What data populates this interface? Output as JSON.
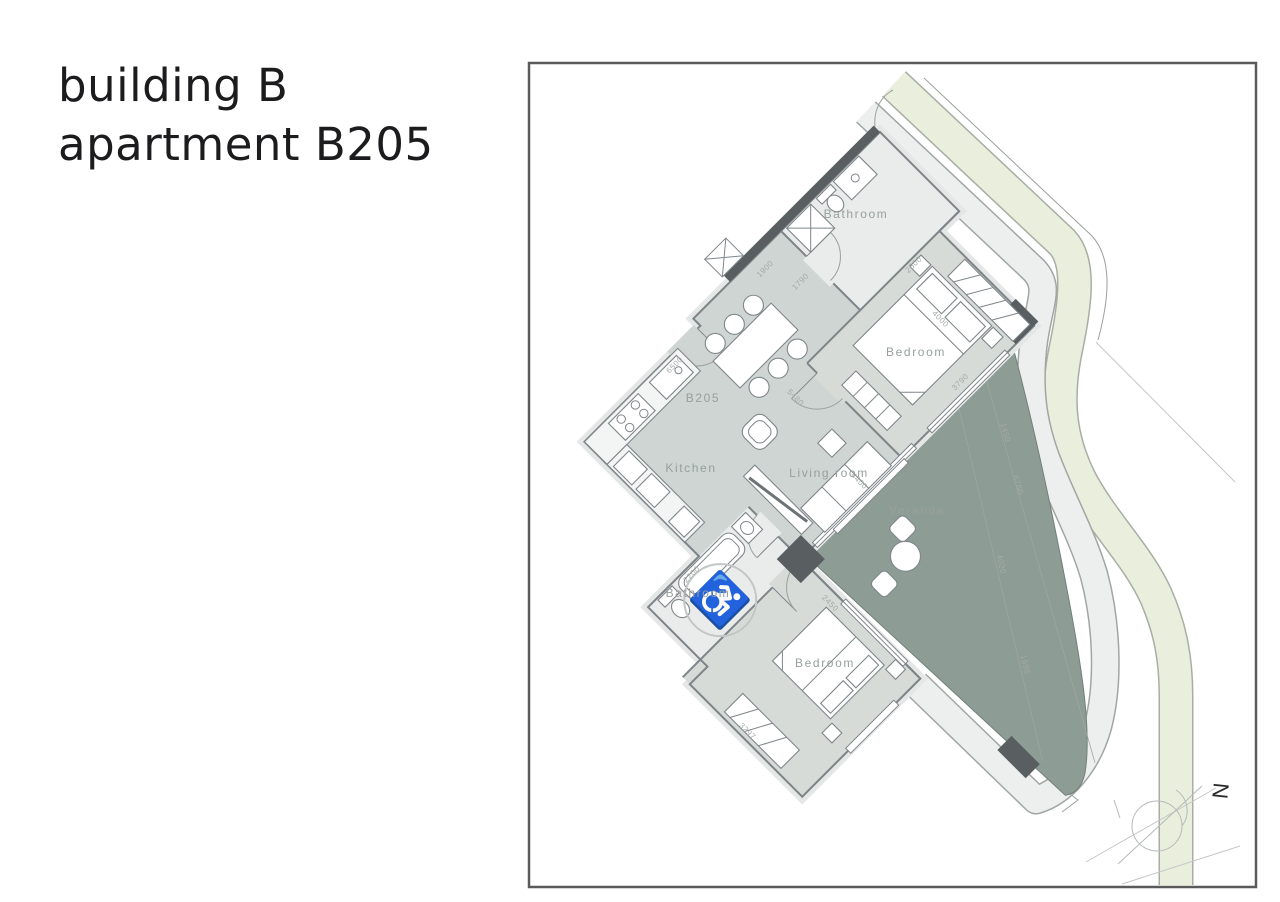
{
  "header": {
    "line1": "building B",
    "line2": "apartment B205"
  },
  "plan": {
    "room_labels": [
      {
        "text": "Bathroom"
      },
      {
        "text": "Bedroom"
      },
      {
        "text": "B205"
      },
      {
        "text": "Kitchen"
      },
      {
        "text": "Living  room"
      },
      {
        "text": "Veranda"
      },
      {
        "text": "Bathroom"
      },
      {
        "text": "Bedroom"
      }
    ],
    "dimensions": [
      "1790",
      "2500",
      "1900",
      "4000",
      "3790",
      "6500",
      "5480",
      "4400",
      "1450",
      "6760",
      "4020",
      "1695",
      "2200",
      "2450",
      "3297"
    ],
    "compass": {
      "letter": "N"
    },
    "icons": {
      "accessibility": "wheelchair-icon"
    }
  },
  "colors": {
    "floor": "#ced5d2",
    "bedroom_floor": "#d6dbd8",
    "bathroom_floor": "#e9eceb",
    "veranda": "#8d9c95",
    "green_strip": "#e9efdc",
    "walkway": "#edefee",
    "dark_wall": "#595e60",
    "wall_line": "#7e8487",
    "label_text": "#98a09d",
    "frame": "#5a5a5a"
  }
}
